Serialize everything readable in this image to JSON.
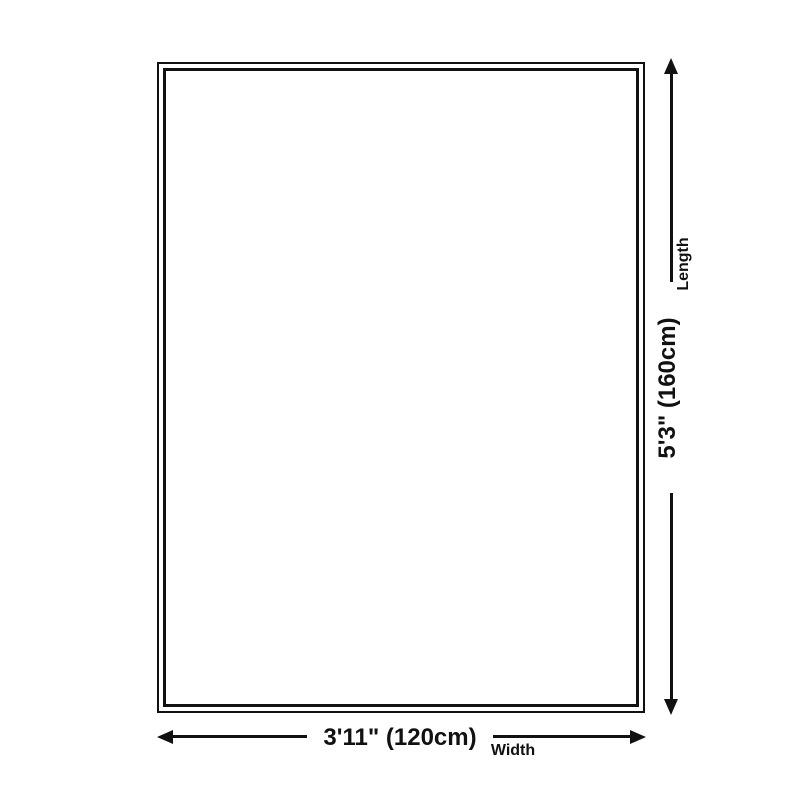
{
  "diagram": {
    "type": "product-size-diagram",
    "length": {
      "value": "5'3\" (160cm)",
      "label": "Length"
    },
    "width": {
      "value": "3'11\" (120cm)",
      "label": "Width"
    },
    "colors": {
      "line": "#111111",
      "background": "#ffffff"
    }
  }
}
